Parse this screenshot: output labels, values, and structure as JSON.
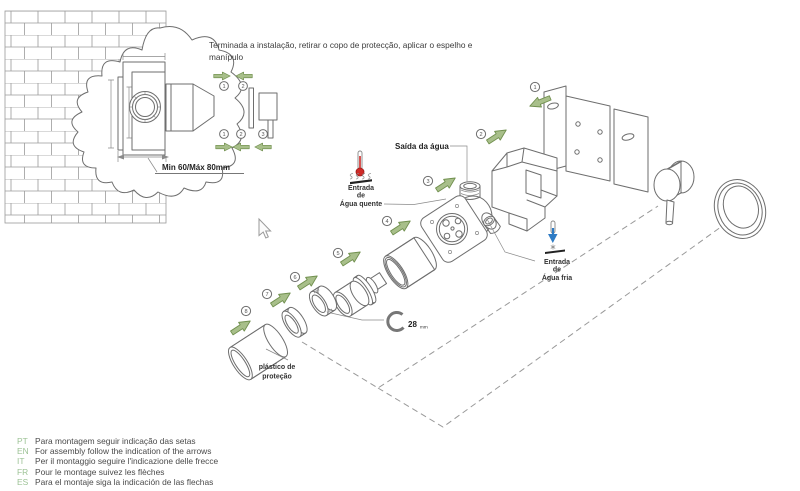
{
  "page": {
    "background": "#ffffff"
  },
  "top_note": {
    "line1": "Terminada a instalação, retirar o copo de protecção, aplicar o espelho e",
    "line2": "manípulo"
  },
  "cross_section": {
    "dimension": "Min 60/Máx 80mm"
  },
  "finish_steps": {
    "top": [
      "1",
      "2"
    ],
    "bottom": [
      "1",
      "2",
      "3"
    ]
  },
  "exploded": {
    "steps": [
      "1",
      "2",
      "3",
      "4",
      "5",
      "6",
      "7",
      "8"
    ],
    "labels": {
      "outlet": "Saída da água",
      "hot_line1": "Entrada",
      "hot_line2": "de",
      "hot_line3": "Água quente",
      "cold_line1": "Entrada",
      "cold_line2": "de",
      "cold_line3": "Água fria",
      "protection_line1": "plástico de",
      "protection_line2": "proteção",
      "wrench_size": "28",
      "wrench_unit": "mm"
    }
  },
  "footer": {
    "items": [
      {
        "code": "PT",
        "text": "Para montagem seguir indicação das setas"
      },
      {
        "code": "EN",
        "text": "For assembly follow the indication of the arrows"
      },
      {
        "code": "IT",
        "text": "Per il montaggio seguire l'indicazione delle frecce"
      },
      {
        "code": "FR",
        "text": "Pour le montage suivez les flèches"
      },
      {
        "code": "ES",
        "text": "Para el montaje siga la indicación de las flechas"
      }
    ]
  },
  "colors": {
    "arrow_green": "#a8bf8a",
    "arrow_outline": "#71904f",
    "lang_code_green": "#9cc295",
    "hot_red": "#cf2a27",
    "cold_blue": "#2e7bc4",
    "line_gray": "#6e6e6e"
  }
}
